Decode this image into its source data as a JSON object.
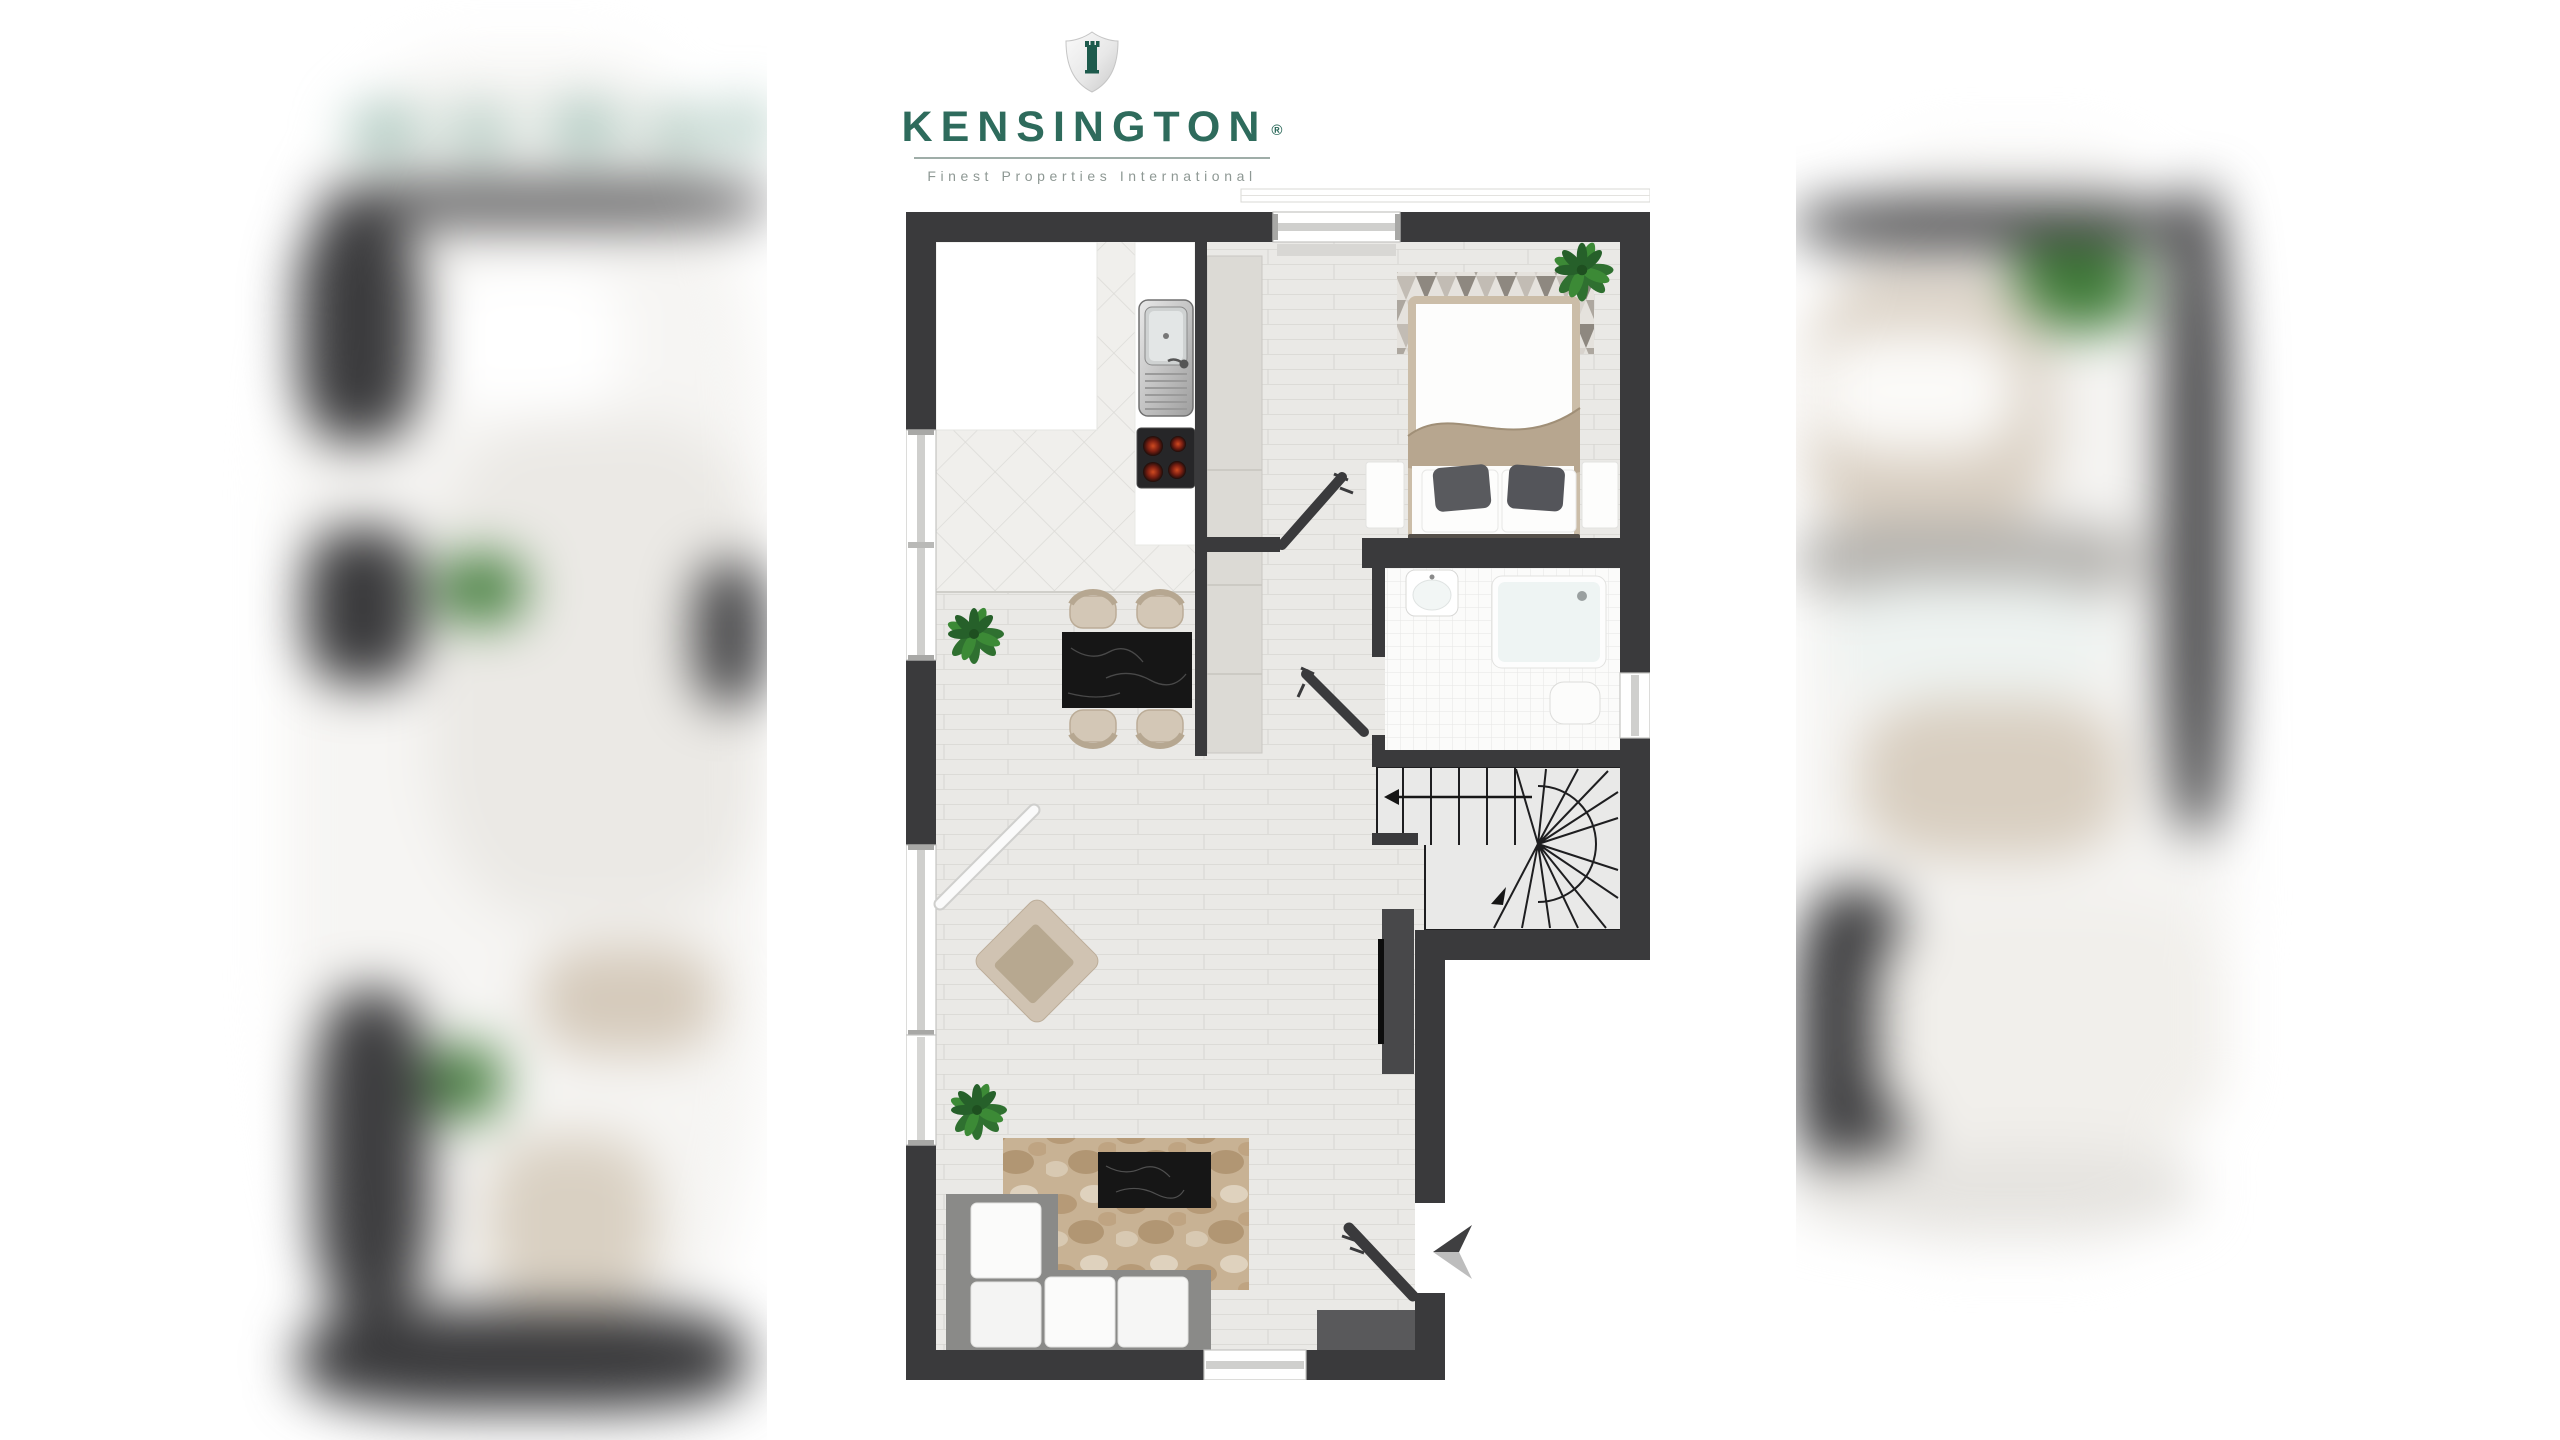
{
  "logo": {
    "brand": "KENSINGTON",
    "registered": "®",
    "tagline": "Finest Properties International"
  },
  "colors": {
    "brand_green": "#2E6B5C",
    "shield_green": "#1D5A4C",
    "tagline_gray": "#8E9894",
    "rule_gray": "#9FADA8",
    "wall": "#3A3A3C",
    "wood": "#EAE9E6",
    "tile": "#F0EFEC",
    "bath": "#FBFBFA",
    "stair_floor": "#E9E9E8",
    "cabinet": "#DCDAD5",
    "counter": "#FFFFFF",
    "beige": "#CEC1B0",
    "beige_dark": "#B7A68F",
    "marble": "#161616",
    "rug_brown": "#C7B193",
    "plant_green": "#2F7030",
    "sofa_frame": "#8A8A88",
    "cushion": "#FAFAFA",
    "dark_furniture": "#48484A",
    "window_frame": "#C9C8C4",
    "arrow_dark": "#3F3F41",
    "arrow_light": "#BDBDBD"
  },
  "floorplan": {
    "rooms": [
      "kitchen",
      "hallway",
      "bedroom",
      "bathroom",
      "staircase",
      "dining-area",
      "living-room"
    ],
    "furniture": [
      "kitchen-counter",
      "sink",
      "hob",
      "hall-wardrobe",
      "double-bed",
      "bedroom-rug",
      "washbasin",
      "shower",
      "toilet",
      "dining-table",
      "dining-chairs",
      "armchair",
      "corner-sofa",
      "coffee-table",
      "living-rug",
      "tv-sideboard",
      "entry-cabinet",
      "plants"
    ],
    "doors": [
      "hall-door",
      "bathroom-door",
      "entrance-door",
      "balcony-door"
    ],
    "stairs": "winder-staircase-with-up-arrow",
    "entrance_marker": "arrow-pointing-to-entrance-door"
  },
  "side_previews": {
    "left": "blurred adjacent floor-plan page",
    "right": "blurred adjacent floor-plan page"
  }
}
